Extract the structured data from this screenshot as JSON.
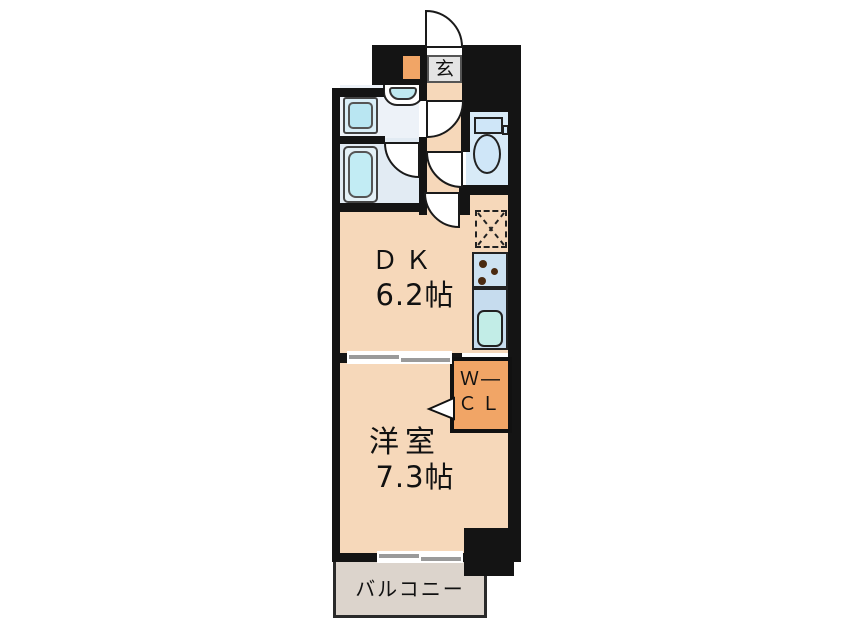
{
  "plan": {
    "rooms": {
      "entrance": {
        "label": "玄"
      },
      "dining_kitchen": {
        "label": "ＤＫ",
        "size": "6.2帖"
      },
      "western_room": {
        "label": "洋室",
        "size": "7.3帖"
      },
      "walk_in_closet": {
        "label_line1": "Ｗ―",
        "label_line2": "ＣＬ"
      },
      "balcony": {
        "label": "バルコニー"
      }
    },
    "colors": {
      "floor": "#f6d8ba",
      "closet_orange": "#f1a566",
      "shaft_orange": "#f1a566",
      "balcony": "#dcd4cc",
      "entrance_grey": "#e4e4e4",
      "washroom": "#edf2f8",
      "bathroom": "#e2ebf3",
      "toilet": "#d8eaf7",
      "fixture_cyan": "#c2ecf4",
      "kitchen_panel": "#cde2f1",
      "sink_cyan": "#c2ede7",
      "wall": "#141414"
    }
  }
}
